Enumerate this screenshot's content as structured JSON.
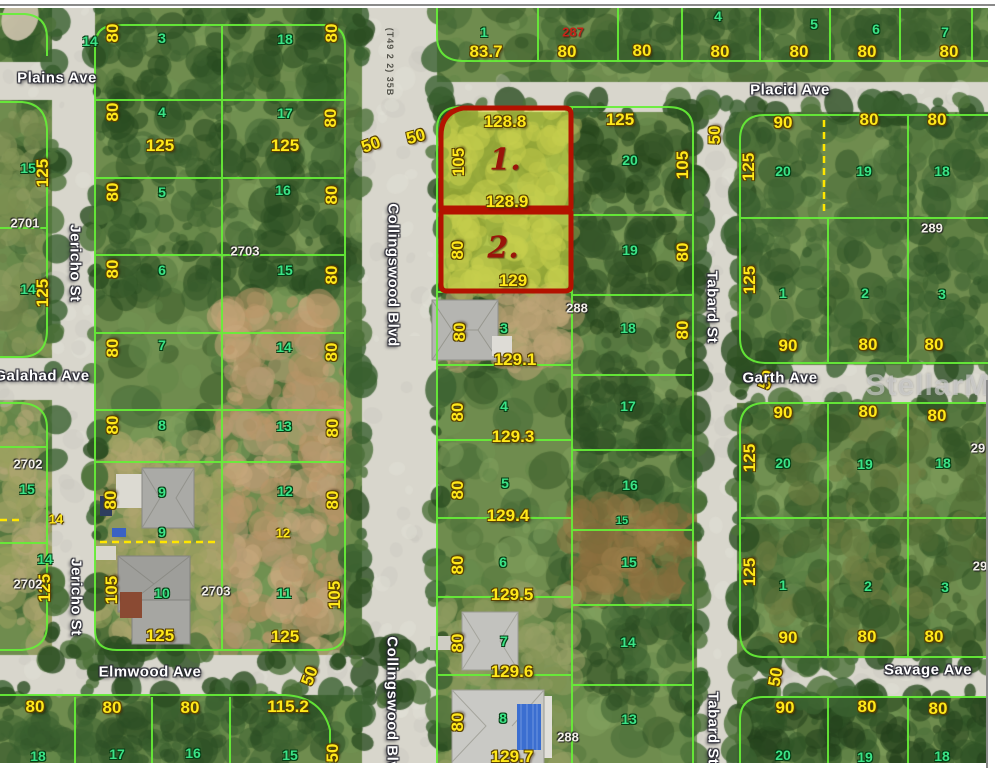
{
  "map": {
    "title": "Aerial parcel plat map",
    "watermark": {
      "t": "StellarMLS",
      "x": 948,
      "y": 386
    },
    "colors": {
      "subject_outline": "#b31200",
      "subject_fill": "#e2e946",
      "parcel_line": "#66ef38",
      "dimension_text": "#ffe81a",
      "lot_text": "#3ce387",
      "street_text": "#ffffff",
      "road": "#d8d6cc"
    },
    "streets": [
      {
        "t": "Plains Ave",
        "x": 57,
        "y": 78
      },
      {
        "t": "Placid Ave",
        "x": 790,
        "y": 90
      },
      {
        "t": "Galahad Ave",
        "x": 42,
        "y": 376
      },
      {
        "t": "Garth Ave",
        "x": 780,
        "y": 378
      },
      {
        "t": "Elmwood Ave",
        "x": 150,
        "y": 672
      },
      {
        "t": "Savage Ave",
        "x": 928,
        "y": 670
      },
      {
        "t": "Jericho St",
        "x": 75,
        "y": 263,
        "r": 90
      },
      {
        "t": "Jericho St",
        "x": 76,
        "y": 597,
        "r": 90
      },
      {
        "t": "Collingswood Blvd",
        "x": 393,
        "y": 275,
        "r": 90
      },
      {
        "t": "Collingswood Blvd",
        "x": 392,
        "y": 708,
        "r": 90
      },
      {
        "t": "Tabard St",
        "x": 712,
        "y": 307,
        "r": 90
      },
      {
        "t": "Tabard St",
        "x": 713,
        "y": 728,
        "r": 90
      }
    ],
    "misc": [
      {
        "t": "(T49 2 2) 35B",
        "x": 390,
        "y": 62,
        "r": 90
      }
    ],
    "subject_markers": [
      {
        "t": "1.",
        "x": 505,
        "y": 160
      },
      {
        "t": "2.",
        "x": 503,
        "y": 248
      }
    ],
    "plat_numbers": [
      {
        "t": "2701",
        "x": 25,
        "y": 223
      },
      {
        "t": "2703",
        "x": 245,
        "y": 251
      },
      {
        "t": "2702",
        "x": 28,
        "y": 464
      },
      {
        "t": "2702",
        "x": 28,
        "y": 584
      },
      {
        "t": "2703",
        "x": 216,
        "y": 591
      },
      {
        "t": "287",
        "x": 573,
        "y": 32,
        "c": "plat-red"
      },
      {
        "t": "288",
        "x": 577,
        "y": 308
      },
      {
        "t": "288",
        "x": 568,
        "y": 737
      },
      {
        "t": "289",
        "x": 932,
        "y": 228
      },
      {
        "t": "29",
        "x": 978,
        "y": 448
      },
      {
        "t": "29",
        "x": 980,
        "y": 566
      }
    ],
    "lot_numbers": [
      {
        "t": "14",
        "x": 90,
        "y": 41
      },
      {
        "t": "15",
        "x": 28,
        "y": 168
      },
      {
        "t": "14",
        "x": 28,
        "y": 289
      },
      {
        "t": "15",
        "x": 27,
        "y": 489
      },
      {
        "t": "14",
        "x": 45,
        "y": 559
      },
      {
        "t": "18",
        "x": 38,
        "y": 756
      },
      {
        "t": "3",
        "x": 162,
        "y": 38
      },
      {
        "t": "18",
        "x": 285,
        "y": 39
      },
      {
        "t": "4",
        "x": 162,
        "y": 112
      },
      {
        "t": "17",
        "x": 285,
        "y": 113
      },
      {
        "t": "5",
        "x": 162,
        "y": 192
      },
      {
        "t": "16",
        "x": 283,
        "y": 190
      },
      {
        "t": "6",
        "x": 162,
        "y": 270
      },
      {
        "t": "15",
        "x": 285,
        "y": 270
      },
      {
        "t": "7",
        "x": 162,
        "y": 345
      },
      {
        "t": "14",
        "x": 284,
        "y": 347
      },
      {
        "t": "8",
        "x": 162,
        "y": 425
      },
      {
        "t": "13",
        "x": 284,
        "y": 426
      },
      {
        "t": "9",
        "x": 162,
        "y": 492
      },
      {
        "t": "12",
        "x": 285,
        "y": 491
      },
      {
        "t": "9",
        "x": 162,
        "y": 532
      },
      {
        "t": "10",
        "x": 162,
        "y": 593
      },
      {
        "t": "11",
        "x": 284,
        "y": 593
      },
      {
        "t": "17",
        "x": 117,
        "y": 754
      },
      {
        "t": "16",
        "x": 193,
        "y": 753
      },
      {
        "t": "15",
        "x": 290,
        "y": 755
      },
      {
        "t": "1",
        "x": 484,
        "y": 32
      },
      {
        "t": "4",
        "x": 718,
        "y": 16
      },
      {
        "t": "5",
        "x": 814,
        "y": 24
      },
      {
        "t": "6",
        "x": 876,
        "y": 29
      },
      {
        "t": "7",
        "x": 945,
        "y": 32
      },
      {
        "t": "20",
        "x": 630,
        "y": 160
      },
      {
        "t": "19",
        "x": 630,
        "y": 250
      },
      {
        "t": "18",
        "x": 628,
        "y": 328
      },
      {
        "t": "17",
        "x": 628,
        "y": 406
      },
      {
        "t": "16",
        "x": 630,
        "y": 485
      },
      {
        "t": "15",
        "x": 622,
        "y": 521,
        "c": "lot",
        "s": 11
      },
      {
        "t": "15",
        "x": 629,
        "y": 562
      },
      {
        "t": "14",
        "x": 628,
        "y": 642
      },
      {
        "t": "13",
        "x": 629,
        "y": 719
      },
      {
        "t": "3",
        "x": 504,
        "y": 328
      },
      {
        "t": "4",
        "x": 504,
        "y": 406
      },
      {
        "t": "5",
        "x": 505,
        "y": 483
      },
      {
        "t": "6",
        "x": 503,
        "y": 562
      },
      {
        "t": "7",
        "x": 504,
        "y": 641
      },
      {
        "t": "8",
        "x": 503,
        "y": 718
      },
      {
        "t": "20",
        "x": 783,
        "y": 171
      },
      {
        "t": "19",
        "x": 864,
        "y": 171
      },
      {
        "t": "18",
        "x": 942,
        "y": 171
      },
      {
        "t": "1",
        "x": 783,
        "y": 293
      },
      {
        "t": "2",
        "x": 865,
        "y": 293
      },
      {
        "t": "3",
        "x": 942,
        "y": 294
      },
      {
        "t": "20",
        "x": 783,
        "y": 463
      },
      {
        "t": "19",
        "x": 865,
        "y": 464
      },
      {
        "t": "18",
        "x": 943,
        "y": 463
      },
      {
        "t": "1",
        "x": 783,
        "y": 585
      },
      {
        "t": "2",
        "x": 868,
        "y": 586
      },
      {
        "t": "3",
        "x": 945,
        "y": 587
      },
      {
        "t": "20",
        "x": 783,
        "y": 755
      },
      {
        "t": "19",
        "x": 865,
        "y": 757
      },
      {
        "t": "18",
        "x": 942,
        "y": 756
      }
    ],
    "dimensions": [
      {
        "t": "80",
        "x": 113,
        "y": 33,
        "r": -90
      },
      {
        "t": "80",
        "x": 332,
        "y": 33,
        "r": -90
      },
      {
        "t": "80",
        "x": 113,
        "y": 112,
        "r": -90
      },
      {
        "t": "80",
        "x": 331,
        "y": 118,
        "r": -90
      },
      {
        "t": "125",
        "x": 160,
        "y": 146
      },
      {
        "t": "125",
        "x": 285,
        "y": 146
      },
      {
        "t": "80",
        "x": 113,
        "y": 192,
        "r": -90
      },
      {
        "t": "80",
        "x": 332,
        "y": 195,
        "r": -90
      },
      {
        "t": "80",
        "x": 113,
        "y": 269,
        "r": -90
      },
      {
        "t": "80",
        "x": 332,
        "y": 275,
        "r": -90
      },
      {
        "t": "80",
        "x": 113,
        "y": 348,
        "r": -90
      },
      {
        "t": "80",
        "x": 332,
        "y": 352,
        "r": -90
      },
      {
        "t": "80",
        "x": 113,
        "y": 425,
        "r": -90
      },
      {
        "t": "80",
        "x": 333,
        "y": 428,
        "r": -90
      },
      {
        "t": "80",
        "x": 111,
        "y": 500,
        "r": -90
      },
      {
        "t": "80",
        "x": 333,
        "y": 500,
        "r": -90
      },
      {
        "t": "12",
        "x": 283,
        "y": 533,
        "c": "dim-sm"
      },
      {
        "t": "105",
        "x": 112,
        "y": 590,
        "r": -90
      },
      {
        "t": "105",
        "x": 335,
        "y": 595,
        "r": -90
      },
      {
        "t": "125",
        "x": 160,
        "y": 636
      },
      {
        "t": "125",
        "x": 285,
        "y": 637
      },
      {
        "t": "125",
        "x": 43,
        "y": 173,
        "r": -90
      },
      {
        "t": "125",
        "x": 43,
        "y": 293,
        "r": -90
      },
      {
        "t": "14",
        "x": 56,
        "y": 519,
        "c": "dim-sm"
      },
      {
        "t": "125",
        "x": 45,
        "y": 588,
        "r": -90
      },
      {
        "t": "80",
        "x": 35,
        "y": 707
      },
      {
        "t": "80",
        "x": 112,
        "y": 708
      },
      {
        "t": "80",
        "x": 190,
        "y": 708
      },
      {
        "t": "115.2",
        "x": 288,
        "y": 707
      },
      {
        "t": "50",
        "x": 310,
        "y": 676,
        "r": -70
      },
      {
        "t": "50",
        "x": 333,
        "y": 753,
        "r": -90
      },
      {
        "t": "50",
        "x": 371,
        "y": 145,
        "r": -20
      },
      {
        "t": "50",
        "x": 416,
        "y": 137,
        "r": -15
      },
      {
        "t": "83.7",
        "x": 486,
        "y": 52
      },
      {
        "t": "80",
        "x": 567,
        "y": 52
      },
      {
        "t": "80",
        "x": 642,
        "y": 51
      },
      {
        "t": "80",
        "x": 720,
        "y": 52
      },
      {
        "t": "80",
        "x": 799,
        "y": 52
      },
      {
        "t": "80",
        "x": 867,
        "y": 52
      },
      {
        "t": "80",
        "x": 949,
        "y": 52
      },
      {
        "t": "128.8",
        "x": 505,
        "y": 122
      },
      {
        "t": "105",
        "x": 459,
        "y": 162,
        "r": -90
      },
      {
        "t": "128.9",
        "x": 507,
        "y": 202
      },
      {
        "t": "80",
        "x": 458,
        "y": 250,
        "r": -90
      },
      {
        "t": "129",
        "x": 513,
        "y": 281
      },
      {
        "t": "125",
        "x": 620,
        "y": 120
      },
      {
        "t": "105",
        "x": 683,
        "y": 165,
        "r": -90
      },
      {
        "t": "80",
        "x": 683,
        "y": 252,
        "r": -90
      },
      {
        "t": "80",
        "x": 683,
        "y": 330,
        "r": -90
      },
      {
        "t": "80",
        "x": 460,
        "y": 332,
        "r": -90
      },
      {
        "t": "129.1",
        "x": 515,
        "y": 360
      },
      {
        "t": "80",
        "x": 458,
        "y": 412,
        "r": -90
      },
      {
        "t": "129.3",
        "x": 513,
        "y": 437
      },
      {
        "t": "80",
        "x": 458,
        "y": 490,
        "r": -90
      },
      {
        "t": "129.4",
        "x": 508,
        "y": 516
      },
      {
        "t": "80",
        "x": 458,
        "y": 565,
        "r": -90
      },
      {
        "t": "129.5",
        "x": 512,
        "y": 595
      },
      {
        "t": "80",
        "x": 458,
        "y": 643,
        "r": -90
      },
      {
        "t": "129.6",
        "x": 512,
        "y": 672
      },
      {
        "t": "80",
        "x": 458,
        "y": 722,
        "r": -90
      },
      {
        "t": "129.7",
        "x": 512,
        "y": 757
      },
      {
        "t": "90",
        "x": 783,
        "y": 123
      },
      {
        "t": "80",
        "x": 869,
        "y": 120
      },
      {
        "t": "80",
        "x": 937,
        "y": 120
      },
      {
        "t": "125",
        "x": 749,
        "y": 167,
        "r": -90
      },
      {
        "t": "125",
        "x": 750,
        "y": 280,
        "r": -90
      },
      {
        "t": "90",
        "x": 788,
        "y": 346
      },
      {
        "t": "80",
        "x": 868,
        "y": 345
      },
      {
        "t": "80",
        "x": 934,
        "y": 345
      },
      {
        "t": "50",
        "x": 715,
        "y": 135,
        "r": -90
      },
      {
        "t": "50",
        "x": 767,
        "y": 380,
        "r": -70
      },
      {
        "t": "90",
        "x": 783,
        "y": 413
      },
      {
        "t": "80",
        "x": 868,
        "y": 412
      },
      {
        "t": "80",
        "x": 937,
        "y": 416
      },
      {
        "t": "125",
        "x": 750,
        "y": 458,
        "r": -90
      },
      {
        "t": "125",
        "x": 750,
        "y": 572,
        "r": -90
      },
      {
        "t": "90",
        "x": 788,
        "y": 638
      },
      {
        "t": "80",
        "x": 867,
        "y": 637
      },
      {
        "t": "80",
        "x": 934,
        "y": 637
      },
      {
        "t": "50",
        "x": 776,
        "y": 677,
        "r": -80
      },
      {
        "t": "90",
        "x": 785,
        "y": 708
      },
      {
        "t": "80",
        "x": 867,
        "y": 707
      },
      {
        "t": "80",
        "x": 938,
        "y": 709
      }
    ]
  }
}
